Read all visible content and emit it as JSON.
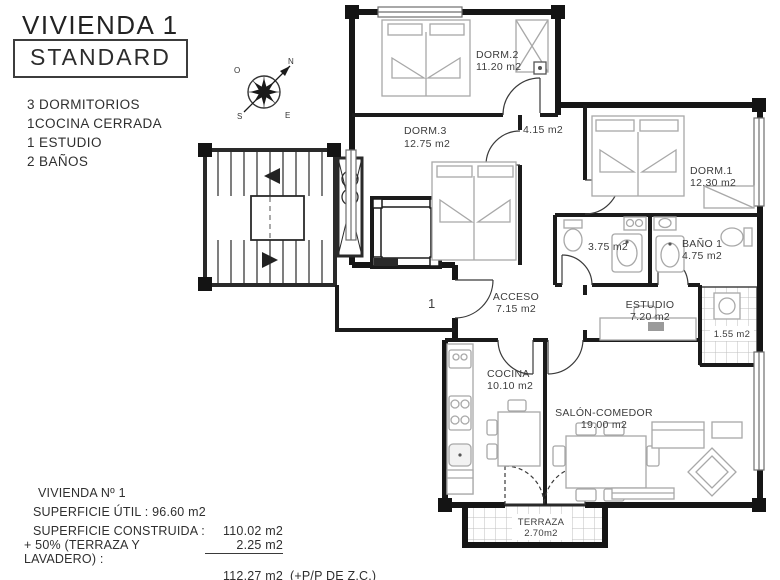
{
  "page": {
    "title": "VIVIENDA 1",
    "badge": "STANDARD"
  },
  "features": {
    "items": [
      "3 DORMITORIOS",
      "1COCINA CERRADA",
      "1 ESTUDIO",
      "2 BAÑOS"
    ]
  },
  "compass": {
    "n": "N",
    "s": "S",
    "e": "E",
    "o": "O"
  },
  "plan": {
    "marker": "1"
  },
  "rooms": {
    "dorm2": {
      "name": "DORM.2",
      "area": "11.20 m2"
    },
    "dorm3": {
      "name": "DORM.3",
      "area": "12.75 m2"
    },
    "hall": {
      "area": "4.15 m2"
    },
    "dorm1": {
      "name": "DORM.1",
      "area": "12.30 m2"
    },
    "bath2": {
      "area": "3.75 m2"
    },
    "bath1": {
      "name": "BAÑO 1",
      "area": "4.75 m2"
    },
    "acceso": {
      "name": "ACCESO",
      "area": "7.15 m2"
    },
    "estudio": {
      "name": "ESTUDIO",
      "area": "7.20 m2"
    },
    "lavadero": {
      "area": "1.55 m2"
    },
    "cocina": {
      "name": "COCINA",
      "area": "10.10 m2"
    },
    "salon": {
      "name": "SALÓN-COMEDOR",
      "area": "19.00 m2"
    },
    "terraza": {
      "name": "TERRAZA",
      "area": "2.70m2"
    }
  },
  "summary": {
    "title": "VIVIENDA Nº 1",
    "util_label": "SUPERFICIE ÚTIL :",
    "util_value": "96.60 m2",
    "construida_label": "SUPERFICIE CONSTRUIDA :",
    "construida_value": "110.02 m2",
    "terraza_label": "+ 50% (TERRAZA Y LAVADERO) :",
    "terraza_value": "2.25 m2",
    "total_value": "112.27 m2",
    "total_suffix": "(+P/P DE Z.C.)"
  },
  "colors": {
    "wall": "#1b1b1b",
    "furniture": "#a8a8a8",
    "grid": "#bfbfbf",
    "text": "#3d3d3d"
  }
}
